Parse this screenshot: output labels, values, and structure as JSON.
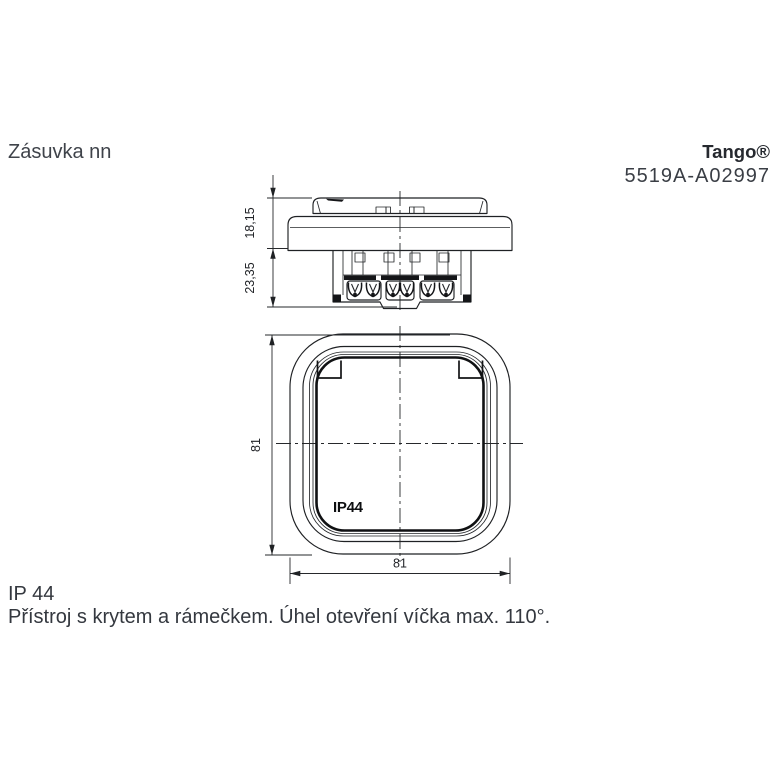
{
  "header": {
    "title": "Zásuvka nn",
    "brand": "Tango®",
    "product_code": "5519A-A02997"
  },
  "drawing": {
    "side_view": {
      "dim_height_top": "18,15",
      "dim_height_bottom": "23,35"
    },
    "front_view": {
      "dim_height": "81",
      "dim_width": "81",
      "lid_marking": "IP44"
    }
  },
  "footer": {
    "ip_rating": "IP 44",
    "description": "Přístroj s krytem a rámečkem. Úhel otevření víčka max. 110°."
  },
  "colors": {
    "line": "#1f2124",
    "thick_line": "#101113",
    "text": "#34383f",
    "brand_text": "#26292f",
    "background": "#ffffff"
  }
}
